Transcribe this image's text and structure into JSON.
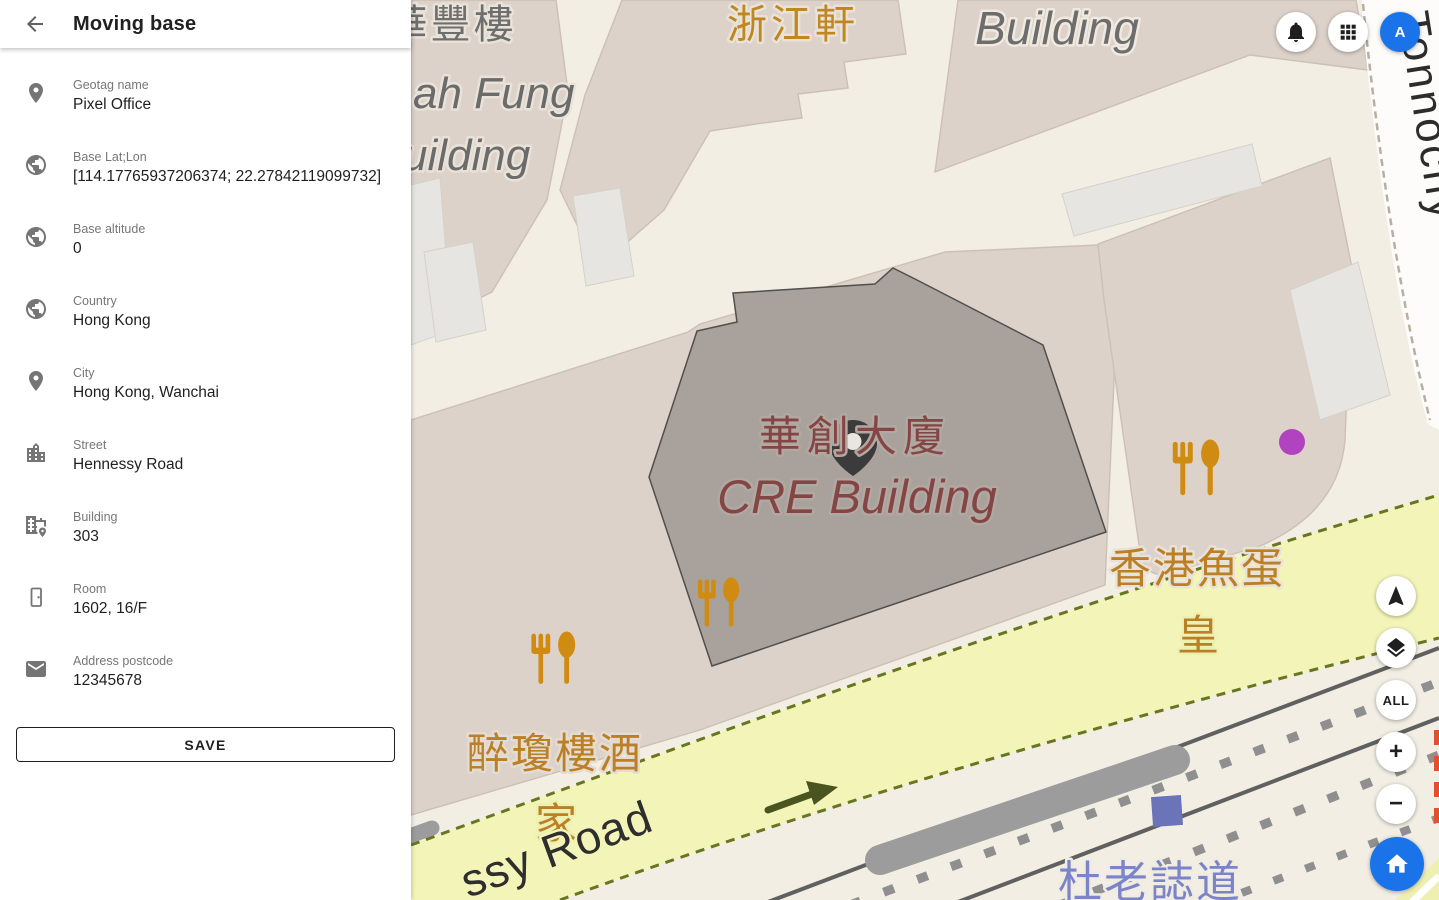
{
  "header": {
    "title": "Moving base"
  },
  "topbar": {
    "avatar_letter": "A"
  },
  "sidebar": {
    "fields": [
      {
        "icon": "place-icon",
        "label": "Geotag name",
        "value": "Pixel Office"
      },
      {
        "icon": "globe-icon",
        "label": "Base Lat;Lon",
        "value": "[114.17765937206374; 22.27842119099732]"
      },
      {
        "icon": "globe-icon",
        "label": "Base altitude",
        "value": "0"
      },
      {
        "icon": "globe-icon",
        "label": "Country",
        "value": "Hong Kong"
      },
      {
        "icon": "place-icon",
        "label": "City",
        "value": "Hong Kong, Wanchai"
      },
      {
        "icon": "city-icon",
        "label": "Street",
        "value": "Hennessy Road"
      },
      {
        "icon": "building-pin-icon",
        "label": "Building",
        "value": "303"
      },
      {
        "icon": "door-icon",
        "label": "Room",
        "value": "1602, 16/F"
      },
      {
        "icon": "email-icon",
        "label": "Address postcode",
        "value": "12345678"
      }
    ],
    "save_label": "SAVE"
  },
  "map": {
    "controls": {
      "all_label": "ALL",
      "zoom_in": "+",
      "zoom_out": "−"
    },
    "labels": {
      "wah_fung_cjk": "華豐樓",
      "wah_fung_en1": "ah Fung",
      "wah_fung_en2": "uilding",
      "zhejiang_heen": "浙江軒",
      "building": "Building",
      "cre_cjk": "華創大廈",
      "cre_en": "CRE Building",
      "fishball_line1": "香港魚蛋",
      "fishball_line2": "皇",
      "restaurant_line1": "醉瓊樓酒",
      "restaurant_line2": "家",
      "hennessy_road": "ssy Road",
      "tonnochy_road": "Tonnochy",
      "tut_lo_chi_road": "杜老誌道"
    },
    "colors": {
      "selected_building": "#a9a19b",
      "building_fill": "#ddd2c9",
      "road_yellow": "#f3f5b8",
      "road_border_olive": "#67761f",
      "poi_orange": "#c9891a",
      "building_label_red": "#854545",
      "road_label_blue": "#7b84c8",
      "marker": "#3b3b3b",
      "accent_blue": "#1a73e8"
    }
  }
}
